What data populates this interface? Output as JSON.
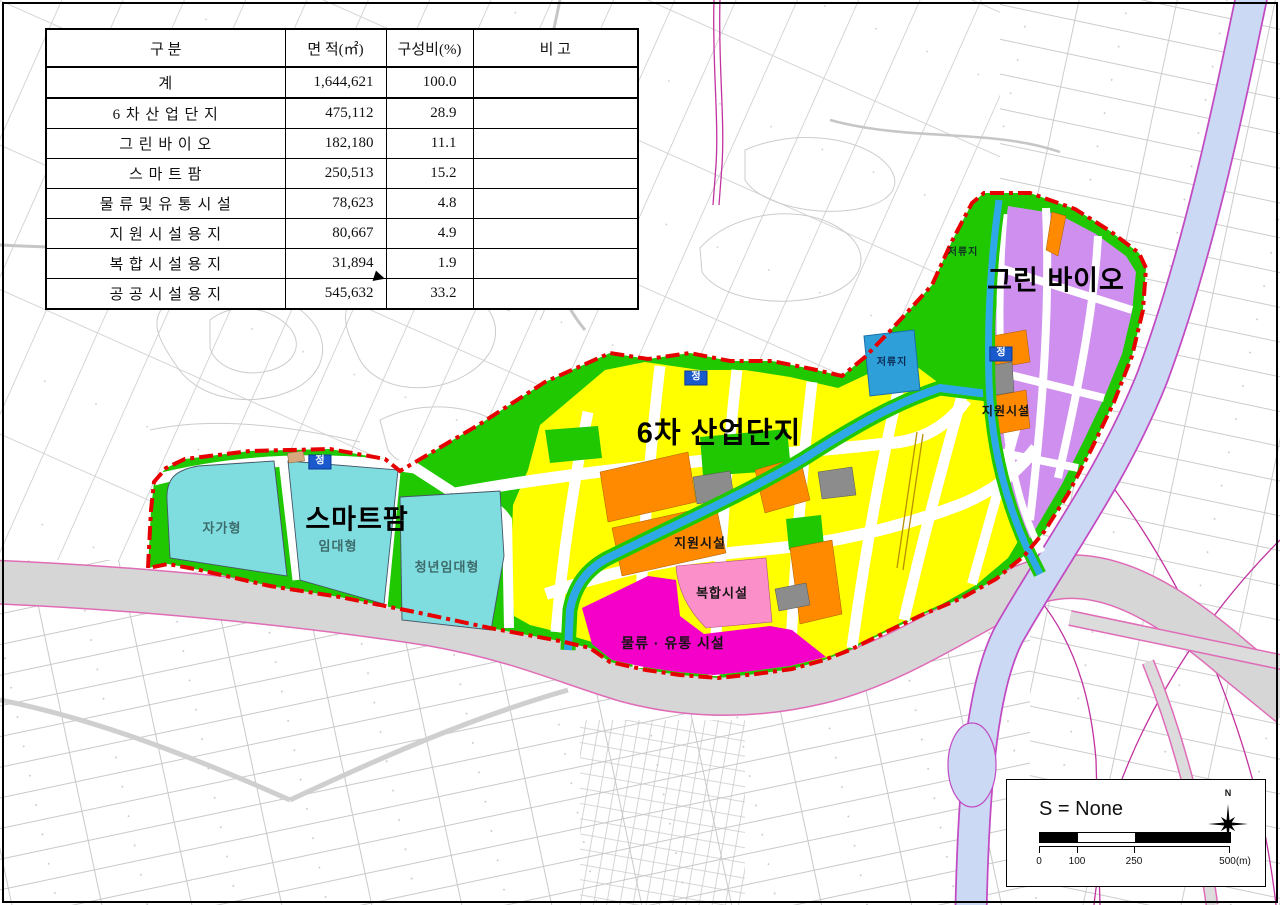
{
  "table": {
    "headers": [
      "구 분",
      "면 적(㎡)",
      "구성비(%)",
      "비 고"
    ],
    "rows": [
      {
        "category": "계",
        "area": "1,644,621",
        "ratio": "100.0",
        "note": ""
      },
      {
        "category": "6 차 산 업 단 지",
        "area": "475,112",
        "ratio": "28.9",
        "note": ""
      },
      {
        "category": "그 린 바 이 오",
        "area": "182,180",
        "ratio": "11.1",
        "note": ""
      },
      {
        "category": "스 마 트 팜",
        "area": "250,513",
        "ratio": "15.2",
        "note": ""
      },
      {
        "category": "물 류 및 유 통 시 설",
        "area": "78,623",
        "ratio": "4.8",
        "note": ""
      },
      {
        "category": "지 원 시 설 용 지",
        "area": "80,667",
        "ratio": "4.9",
        "note": ""
      },
      {
        "category": "복 합 시 설 용 지",
        "area": "31,894",
        "ratio": "1.9",
        "note": ""
      },
      {
        "category": "공 공 시 설 용 지",
        "area": "545,632",
        "ratio": "33.2",
        "note": ""
      }
    ]
  },
  "map": {
    "labels": {
      "industrial": "6차 산업단지",
      "green_bio": "그린 바이오",
      "smart_farm": "스마트팜",
      "sf_self": "자가형",
      "sf_rent": "임대형",
      "sf_youth": "청년임대형",
      "support_mid": "지원시설",
      "support_ne": "지원시설",
      "mixed": "복합시설",
      "logistics": "물류 · 유통 시설",
      "pond_mid": "저류지",
      "pond_ne": "저류지",
      "stop": "정"
    },
    "zone_colors": {
      "industrial": "#FFFF00",
      "green_bio": "#CE8FEE",
      "smart_farm": "#7FDCDF",
      "logistics": "#F500C8",
      "support": "#FF8A00",
      "mixed": "#FB8FC9",
      "green": "#1FC800",
      "water": "#2FA8E8",
      "pond": "#2E9FD9",
      "boundary": "#E60000",
      "stop_box": "#1A5ACC"
    }
  },
  "scale_box": {
    "scale_text": "S = None",
    "ticks": [
      "0",
      "100",
      "250",
      "500(m)"
    ],
    "north": "N"
  }
}
